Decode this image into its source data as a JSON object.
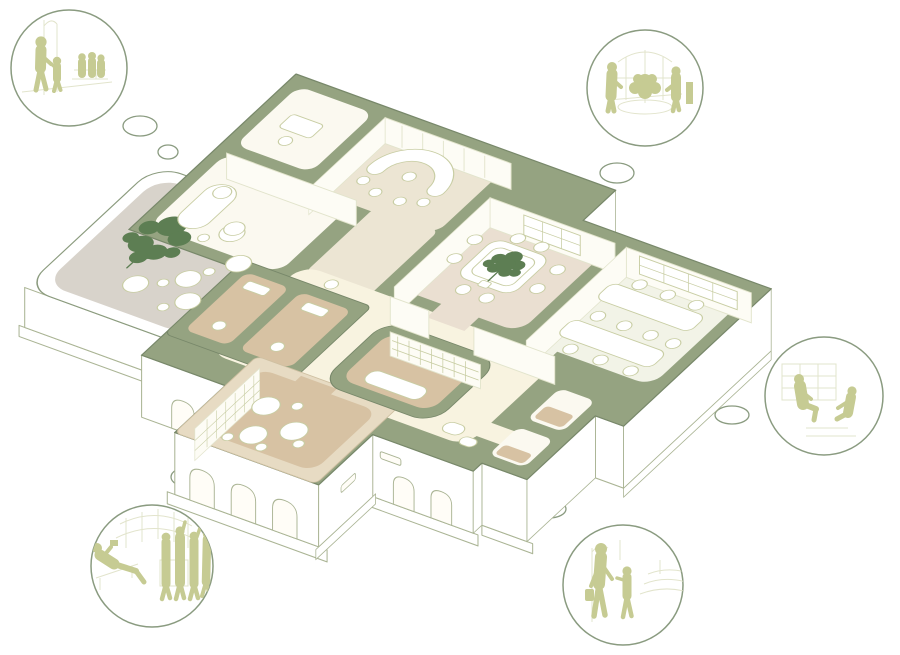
{
  "canvas": {
    "width": 900,
    "height": 655,
    "background": "#ffffff"
  },
  "palette": {
    "wall_green": "#95a381",
    "wall_green_edge": "#78886a",
    "wall_beige": "#e7dbc3",
    "floor_white": "#fbf9f0",
    "floor_beige": "#ece5d3",
    "floor_warm": "#eadfd1",
    "floor_cream": "#f8f3e0",
    "floor_tan": "#d7c2a3",
    "floor_gray": "#d8d3cb",
    "floor_office": "#f2f3e7",
    "line_light": "#e2e4cc",
    "line_mid": "#c8cda3",
    "facade_line": "#aab494",
    "outline": "#8b9b7e",
    "plant_green": "#5d7e53",
    "figure_olive": "#c6cb93",
    "bubble_stroke": "#8a9b80"
  },
  "diagram": {
    "type": "axonometric-floor-plan-cutaway",
    "rooms": [
      "reception-room",
      "small-office",
      "meeting-room",
      "open-office",
      "central-hall",
      "storage-core",
      "lounge",
      "washrooms",
      "terrace",
      "service-rooms"
    ],
    "plants": 2
  },
  "vignettes": [
    {
      "id": "top-left",
      "scene": "family-waiting-area",
      "figures": 5
    },
    {
      "id": "top-right",
      "scene": "plant-room-conversation",
      "figures": 2
    },
    {
      "id": "right",
      "scene": "seated-consultation",
      "figures": 2
    },
    {
      "id": "bottom-right",
      "scene": "parent-and-child-walking",
      "figures": 2
    },
    {
      "id": "bottom-left",
      "scene": "lounge-reading-and-group",
      "figures": 5
    }
  ],
  "bubbles": {
    "count": 11
  }
}
